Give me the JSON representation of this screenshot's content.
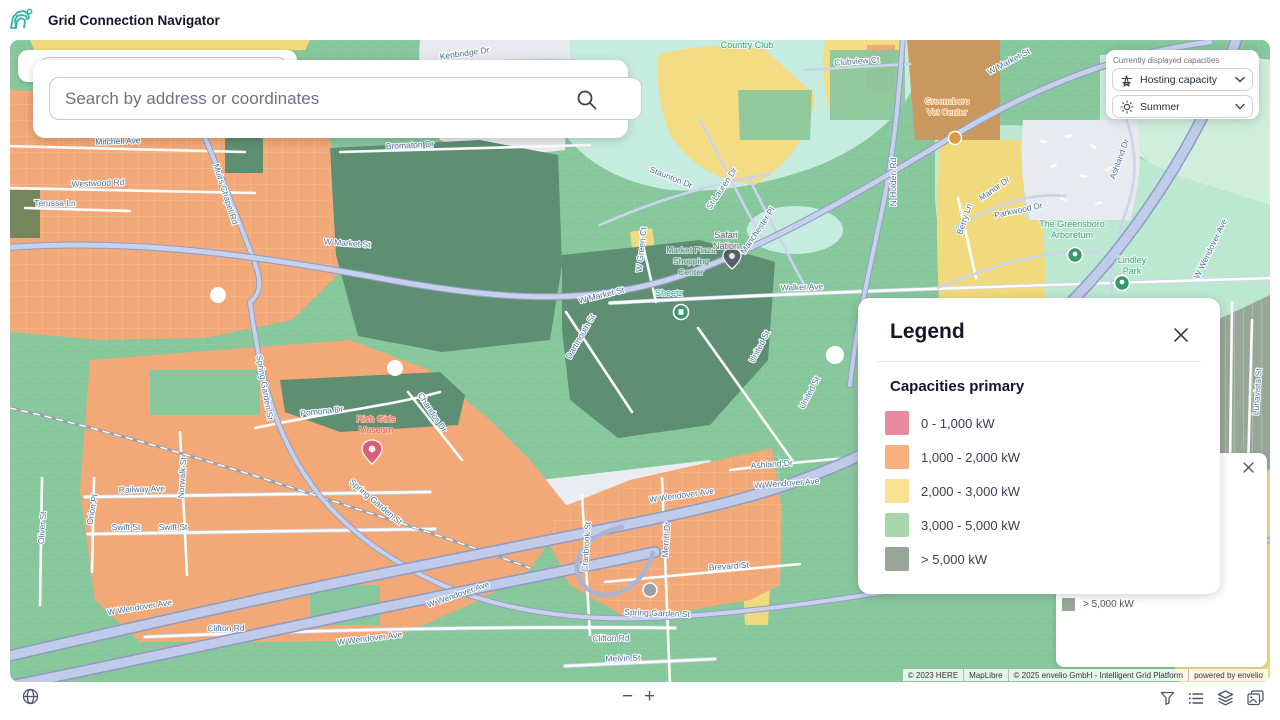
{
  "header": {
    "title": "Grid Connection Navigator"
  },
  "search": {
    "placeholder": "Search by address or coordinates"
  },
  "capacities_panel": {
    "label": "Currently displayed capacities",
    "dropdowns": [
      {
        "label": "Hosting capacity",
        "icon": "pylon-icon"
      },
      {
        "label": "Summer",
        "icon": "sun-icon"
      }
    ]
  },
  "legend": {
    "title": "Legend",
    "section": "Capacities primary",
    "items": [
      {
        "label": "0 - 1,000 kW",
        "color": "#e78a9e"
      },
      {
        "label": "1,000 - 2,000 kW",
        "color": "#f6b17e"
      },
      {
        "label": "2,000 - 3,000 kW",
        "color": "#f9e292"
      },
      {
        "label": "3,000 - 5,000 kW",
        "color": "#a9d5ac"
      },
      {
        "label": "> 5,000 kW",
        "color": "#95a696"
      }
    ]
  },
  "stale_legend": {
    "item": {
      "label": "> 5,000 kW",
      "color": "#95a696"
    }
  },
  "attribution": {
    "segments": [
      "© 2023 HERE",
      "MapLibre",
      "© 2025 envelio GmbH - Intelligent Grid Platform",
      "powered by envelio"
    ]
  },
  "footer": {
    "zoom_out": "−",
    "zoom_in": "+"
  },
  "map": {
    "labels": {
      "kenbridge": "Kenbridge Dr",
      "country_club": "Country Club",
      "clubview": "Clubview Ct",
      "staunton": "Staunton Dr",
      "st_lauren": "St Lauren Dr",
      "manchester": "Manchester Pl",
      "holden": "N Holden Rd",
      "market1": "W Market St",
      "market2": "W Market St",
      "market3": "W Market St",
      "bromaton": "Bromaton Dr",
      "mitchell": "Mitchell Ave",
      "westwood": "Westwood Rd",
      "terussa": "Terussa Ln",
      "muirs": "Muirs Chapel Rd",
      "spring_v": "Spring Garden St",
      "spring_d": "Spring Garden St",
      "spring_h": "Spring Garden St",
      "walker": "Walker Ave",
      "green_ct": "W Green Ct",
      "dartmouth": "Dartmouth St",
      "united1": "United St",
      "united2": "United St",
      "pomona": "Pomona Dr",
      "chandos": "Chandos Dr",
      "railway": "Railway Ave",
      "swift1": "Swift St",
      "swift2": "Swift St",
      "orion": "Orion Pl",
      "norwalk": "Norwalk St",
      "oliver": "Oliver St",
      "wendover1": "W Wendover Ave",
      "wendover2": "W Wendover Ave",
      "wendover3": "W Wendover Ave",
      "wendover4": "W Wendover Ave",
      "wendover5": "W Wendover Ave",
      "wendover6": "W Wendover Ave",
      "wendover7": "W Wendover Ave",
      "clifton1": "Clifton Rd",
      "clifton2": "Clifton Rd",
      "melvin": "Melvin St",
      "merritt": "Merritt Dr",
      "brevard": "Brevard St",
      "cranbrook": "Cranbrook St",
      "ashland1": "Ashland Dr",
      "ashland2": "Ashland Dr",
      "parkwood": "Parkwood Dr",
      "manor": "Manor Dr",
      "berry": "Berry Ln",
      "lunavista": "Lunavista St",
      "mp1": "Market Plaza",
      "mp2": "Shopping",
      "mp3": "Center",
      "safari1": "Safari",
      "safari2": "Nation",
      "sheetz": "Sheetz",
      "museum1": "Rich Girls",
      "museum2": "Museum",
      "vet1": "Greensboro",
      "vet2": "Vet Center",
      "arb1": "The Greensboro",
      "arb2": "Arboretum",
      "lind1": "Lindley",
      "lind2": "Park"
    },
    "colors": {
      "base_green": "#87c79c",
      "dark_green": "#5e8f72",
      "orange": "#f2a877",
      "yellow": "#f3dc83",
      "teal_golf": "#c6ecdf",
      "mint_park": "#bce8d1",
      "sage": "#97a898",
      "tan": "#c9985f",
      "urban_gray": "#e8eaf0",
      "road": "#c7d1ec",
      "road_casing": "#93a0c4"
    }
  }
}
